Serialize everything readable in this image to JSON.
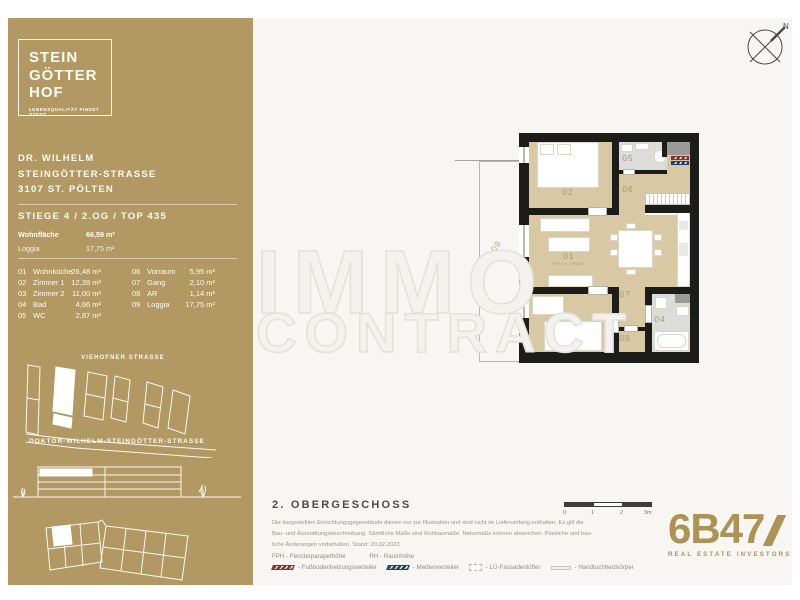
{
  "logo": {
    "lines": [
      "STEIN",
      "GÖTTER",
      "HOF"
    ],
    "tagline": "LEBENSQUALITÄT FINDET STADT"
  },
  "address": {
    "lines": [
      "DR. WILHELM",
      "STEINGÖTTER-STRASSE",
      "3107 ST. PÖLTEN"
    ]
  },
  "unit": {
    "title": "STIEGE 4 / 2.OG / TOP 435"
  },
  "areas": [
    {
      "label": "Wohnfläche",
      "value": "66,59 m²"
    },
    {
      "label": "Loggia",
      "value": "17,75 m²"
    }
  ],
  "rooms_col1": [
    {
      "no": "01",
      "name": "Wohnküche",
      "area": "26,48 m²"
    },
    {
      "no": "02",
      "name": "Zimmer 1",
      "area": "12,39 m²"
    },
    {
      "no": "03",
      "name": "Zimmer 2",
      "area": "11,00 m²"
    },
    {
      "no": "04",
      "name": "Bad",
      "area": "4,66 m²"
    },
    {
      "no": "05",
      "name": "WC",
      "area": "2,87 m²"
    }
  ],
  "rooms_col2": [
    {
      "no": "06",
      "name": "Vorraum",
      "area": "5,95 m²"
    },
    {
      "no": "07",
      "name": "Gang",
      "area": "2,10 m²"
    },
    {
      "no": "08",
      "name": "AR",
      "area": "1,14 m²"
    },
    {
      "no": "09",
      "name": "Loggia",
      "area": "17,75 m²"
    }
  ],
  "sitemap": {
    "street_top": "VIEHOFNER STRASSE",
    "street_bottom": "DOKTOR-WILHELM-STEINGÖTTER-STRASSE"
  },
  "compass": {
    "north": "N"
  },
  "watermark": {
    "line1": "IMMO",
    "line2": "CONTRACT"
  },
  "plan": {
    "room_labels": {
      "r01": "01",
      "r02": "02",
      "r03": "03",
      "r04": "04",
      "r05": "05",
      "r06": "06",
      "r07": "07",
      "r08": "08",
      "r09": "09"
    },
    "r01_sub": "RH ca. 260cm"
  },
  "floor_info": {
    "title": "2. OBERGESCHOSS",
    "disclaimer": [
      "Die dargestellten Einrichtungsgegenstände dienen nur zur Illustration und sind nicht im Lieferumfang enthalten. Es gilt die",
      "Bau- und Ausstattungsbeschreibung. Sämtliche Maße sind Rohbaumaße. Naturmaße können abweichen. Planliche und bau-",
      "liche Änderungen vorbehalten. Stand: 20.02.2023"
    ],
    "abbrev1": "FPH - Fensterparapethöhe",
    "abbrev2": "RH - Raumhöhe",
    "legend": [
      {
        "symbol": "floor-heating-distributor",
        "label": "- Fußbodenheizungsverteiler"
      },
      {
        "symbol": "media-distributor",
        "label": "- Medienverteiler"
      },
      {
        "symbol": "facade-ventilation",
        "label": "- LÜ-Fassadenlüfter"
      },
      {
        "symbol": "towel-radiator",
        "label": "- Handtuchheizkörper"
      }
    ]
  },
  "scalebar": {
    "ticks": [
      "0",
      "1",
      "2",
      "3m"
    ]
  },
  "brand": {
    "name": "6B47",
    "sub": "REAL ESTATE INVESTORS"
  },
  "colors": {
    "sidebar_gold": "#b29862",
    "floor_tan": "#d8c8a4",
    "wet_gray": "#dcdcda",
    "wall": "#1c1c1a",
    "brand_gold": "#ad9256"
  }
}
